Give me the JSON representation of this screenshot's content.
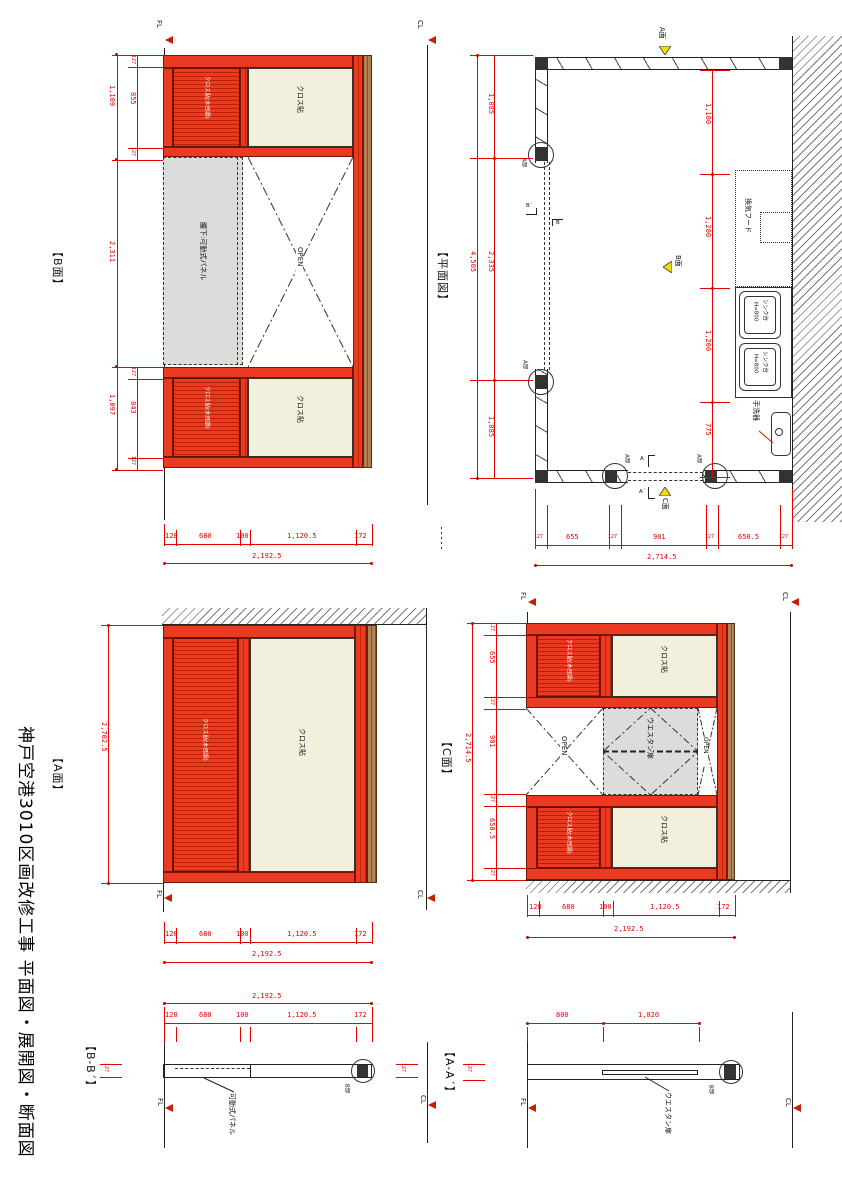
{
  "sheet": {
    "title": "神戸空港3010区画改修工事 平面図・展開図・断面図"
  },
  "colors": {
    "panel_red": "#ea3b22",
    "panel_red_stripe": "#b92104",
    "dim_red": "#e60000",
    "beige": "#f3efdd",
    "gray_panel": "#dcdcdc",
    "brown_edge": "#b28257",
    "marker_yellow": "#f0e000",
    "level_marker_red": "#c22000",
    "line_black": "#222222"
  },
  "common": {
    "fl": "FL",
    "cl": "CL",
    "open": "OPEN",
    "cloth": "クロス貼",
    "cloth_grooved": "クロス貼(木目調)",
    "waist_panel": "腰下:可動式パネル",
    "movable_panel": "可動式パネル",
    "western_door": "ウエスタン扉",
    "detail_a": "A部",
    "detail_b": "B部"
  },
  "plan": {
    "title": "【平面図】",
    "face_a": "A面",
    "face_b": "B面",
    "face_c": "C面",
    "sec_a": "A",
    "sec_a2": "A´",
    "sec_b": "B",
    "sec_b2": "B´",
    "vent_hood": "換気フード",
    "sink": "シンク台",
    "sink_height": "H=800",
    "hand_basin": "手洗器",
    "dim_total_left": "4,505",
    "dims_left": [
      "1,085",
      "2,335",
      "1,085"
    ],
    "dims_right": [
      "1,100",
      "1,200",
      "1,200",
      "775"
    ],
    "dim_total_bottom": "2,714.5",
    "dims_bottom": [
      "127",
      "655",
      "127",
      "901",
      "127",
      "650.5",
      "127"
    ]
  },
  "b_elev": {
    "title": "【B面】",
    "g1": [
      "127",
      "855",
      "127"
    ],
    "g1_total": "1,109",
    "mid": "2,311",
    "g2": [
      "127",
      "843",
      "127"
    ],
    "g2_total": "1,097",
    "dims_bottom": [
      "120",
      "680",
      "100",
      "1,120.5",
      "172"
    ],
    "dim_total_bottom": "2,192.5"
  },
  "a_elev": {
    "title": "【A面】",
    "dim_left": "2,702.5",
    "dims_bottom": [
      "120",
      "680",
      "100",
      "1,120.5",
      "172"
    ],
    "dim_total_bottom": "2,192.5"
  },
  "c_elev": {
    "title": "【C面】",
    "dims_left": [
      "127",
      "655",
      "127",
      "901",
      "127",
      "650.5",
      "127"
    ],
    "dim_total_left": "2,714.5",
    "dims_bottom": [
      "120",
      "680",
      "100",
      "1,120.5",
      "172"
    ],
    "dim_total_bottom": "2,192.5"
  },
  "bb_sec": {
    "title": "【B-B´】",
    "dim_total": "2,192.5",
    "dims": [
      "120",
      "680",
      "100",
      "1,120.5",
      "172"
    ],
    "thickness": "127"
  },
  "aa_sec": {
    "title": "【A-A´】",
    "dims": [
      "800",
      "1,020"
    ],
    "thickness": "127"
  }
}
